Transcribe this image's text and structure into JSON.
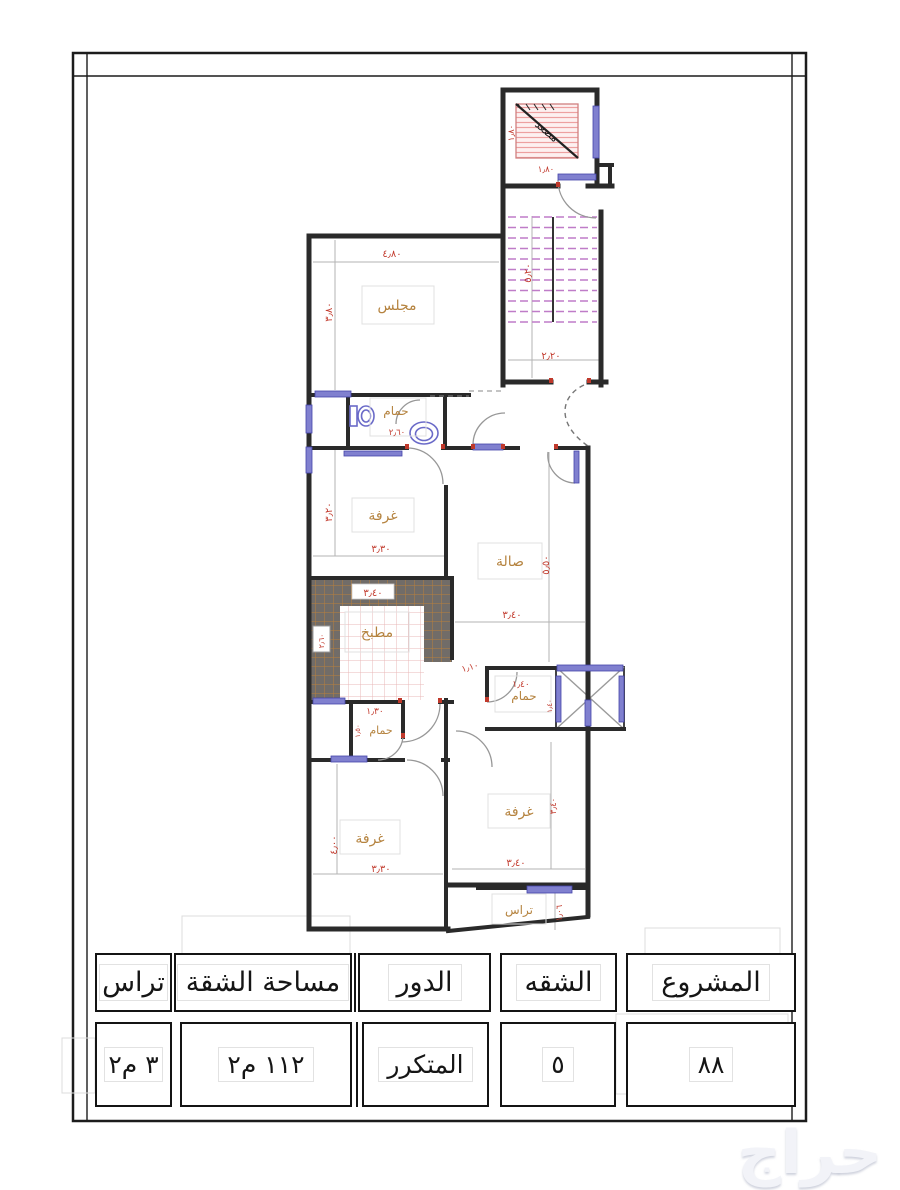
{
  "plan": {
    "rooms": {
      "majlis": {
        "label": "مجلس",
        "width": "٤٫٨٠",
        "height": "٣٫٨٠"
      },
      "bathroom_top": {
        "label": "حمام",
        "width": "٢٫٦٠"
      },
      "bedroom_top": {
        "label": "غرفة",
        "width": "٣٫٣٠",
        "height": "٣٫٢٠"
      },
      "hall": {
        "label": "صالة",
        "width": "٣٫٤٠",
        "height": "٥٫٥٠"
      },
      "kitchen": {
        "label": "مطبخ",
        "width": "٣٫٤٠",
        "height": "٢٫٦٠",
        "opening": "١٫١٠",
        "bottom": "١٫٣٠"
      },
      "bathroom_mid": {
        "label": "حمام",
        "width": "١٫٤٠",
        "height": "١٫٤٠"
      },
      "bathroom_low": {
        "label": "حمام",
        "height": "١٫٥٠"
      },
      "bedroom_left": {
        "label": "غرفة",
        "width": "٣٫٣٠",
        "height": "٤٫٠٠"
      },
      "bedroom_right": {
        "label": "غرفة",
        "width": "٣٫٤٠",
        "height": "٣٫٤٠"
      },
      "terrace": {
        "label": "تراس",
        "height": "١٫٠٦"
      },
      "elevator": {
        "label": "مصعد",
        "width": "١٫٨٠",
        "height": "١٫٨٠"
      },
      "stairs": {
        "width": "٢٫٢٠",
        "height": "٥٫٢٠"
      }
    }
  },
  "table": {
    "columns": [
      {
        "id": "project",
        "header": "المشروع",
        "value": "٨٨"
      },
      {
        "id": "apartment",
        "header": "الشقه",
        "value": "٥"
      },
      {
        "id": "floor",
        "header": "الدور",
        "value": "المتكرر"
      },
      {
        "id": "area",
        "header": "مساحة الشقة",
        "value": "١١٢ م٢"
      },
      {
        "id": "terrace",
        "header": "تراس",
        "value": "٣ م٢"
      }
    ]
  },
  "watermark": "حراج",
  "colors": {
    "wall": "#2a2a2a",
    "dimension": "#c23b2e",
    "room_label": "#b5833f",
    "window": "#8080cf",
    "stair_tread": "#bf7cc8",
    "counter": "#716c68",
    "counter_grid": "#b97f3c",
    "tile_grid": "#e8b9b9",
    "elevator_hatch": "#eda0a0"
  }
}
